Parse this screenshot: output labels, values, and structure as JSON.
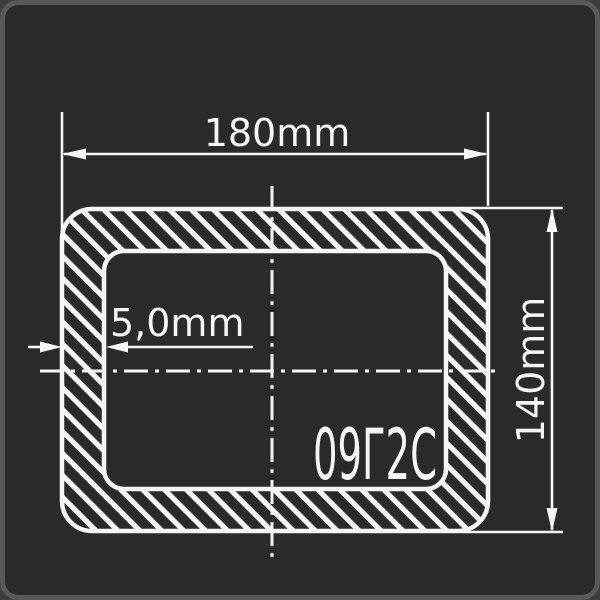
{
  "drawing": {
    "type_label": "rectangular-tube-cross-section",
    "dimensions": {
      "width_label": "180mm",
      "height_label": "140mm",
      "thickness_label": "5,0mm"
    },
    "material": {
      "grade_label": "09Г2С"
    },
    "colors": {
      "canvas_background": "#2b2a2b",
      "frame_border": "#58585a",
      "line_white": "#f5f5f5",
      "page_corner": "#3e3e40"
    }
  }
}
